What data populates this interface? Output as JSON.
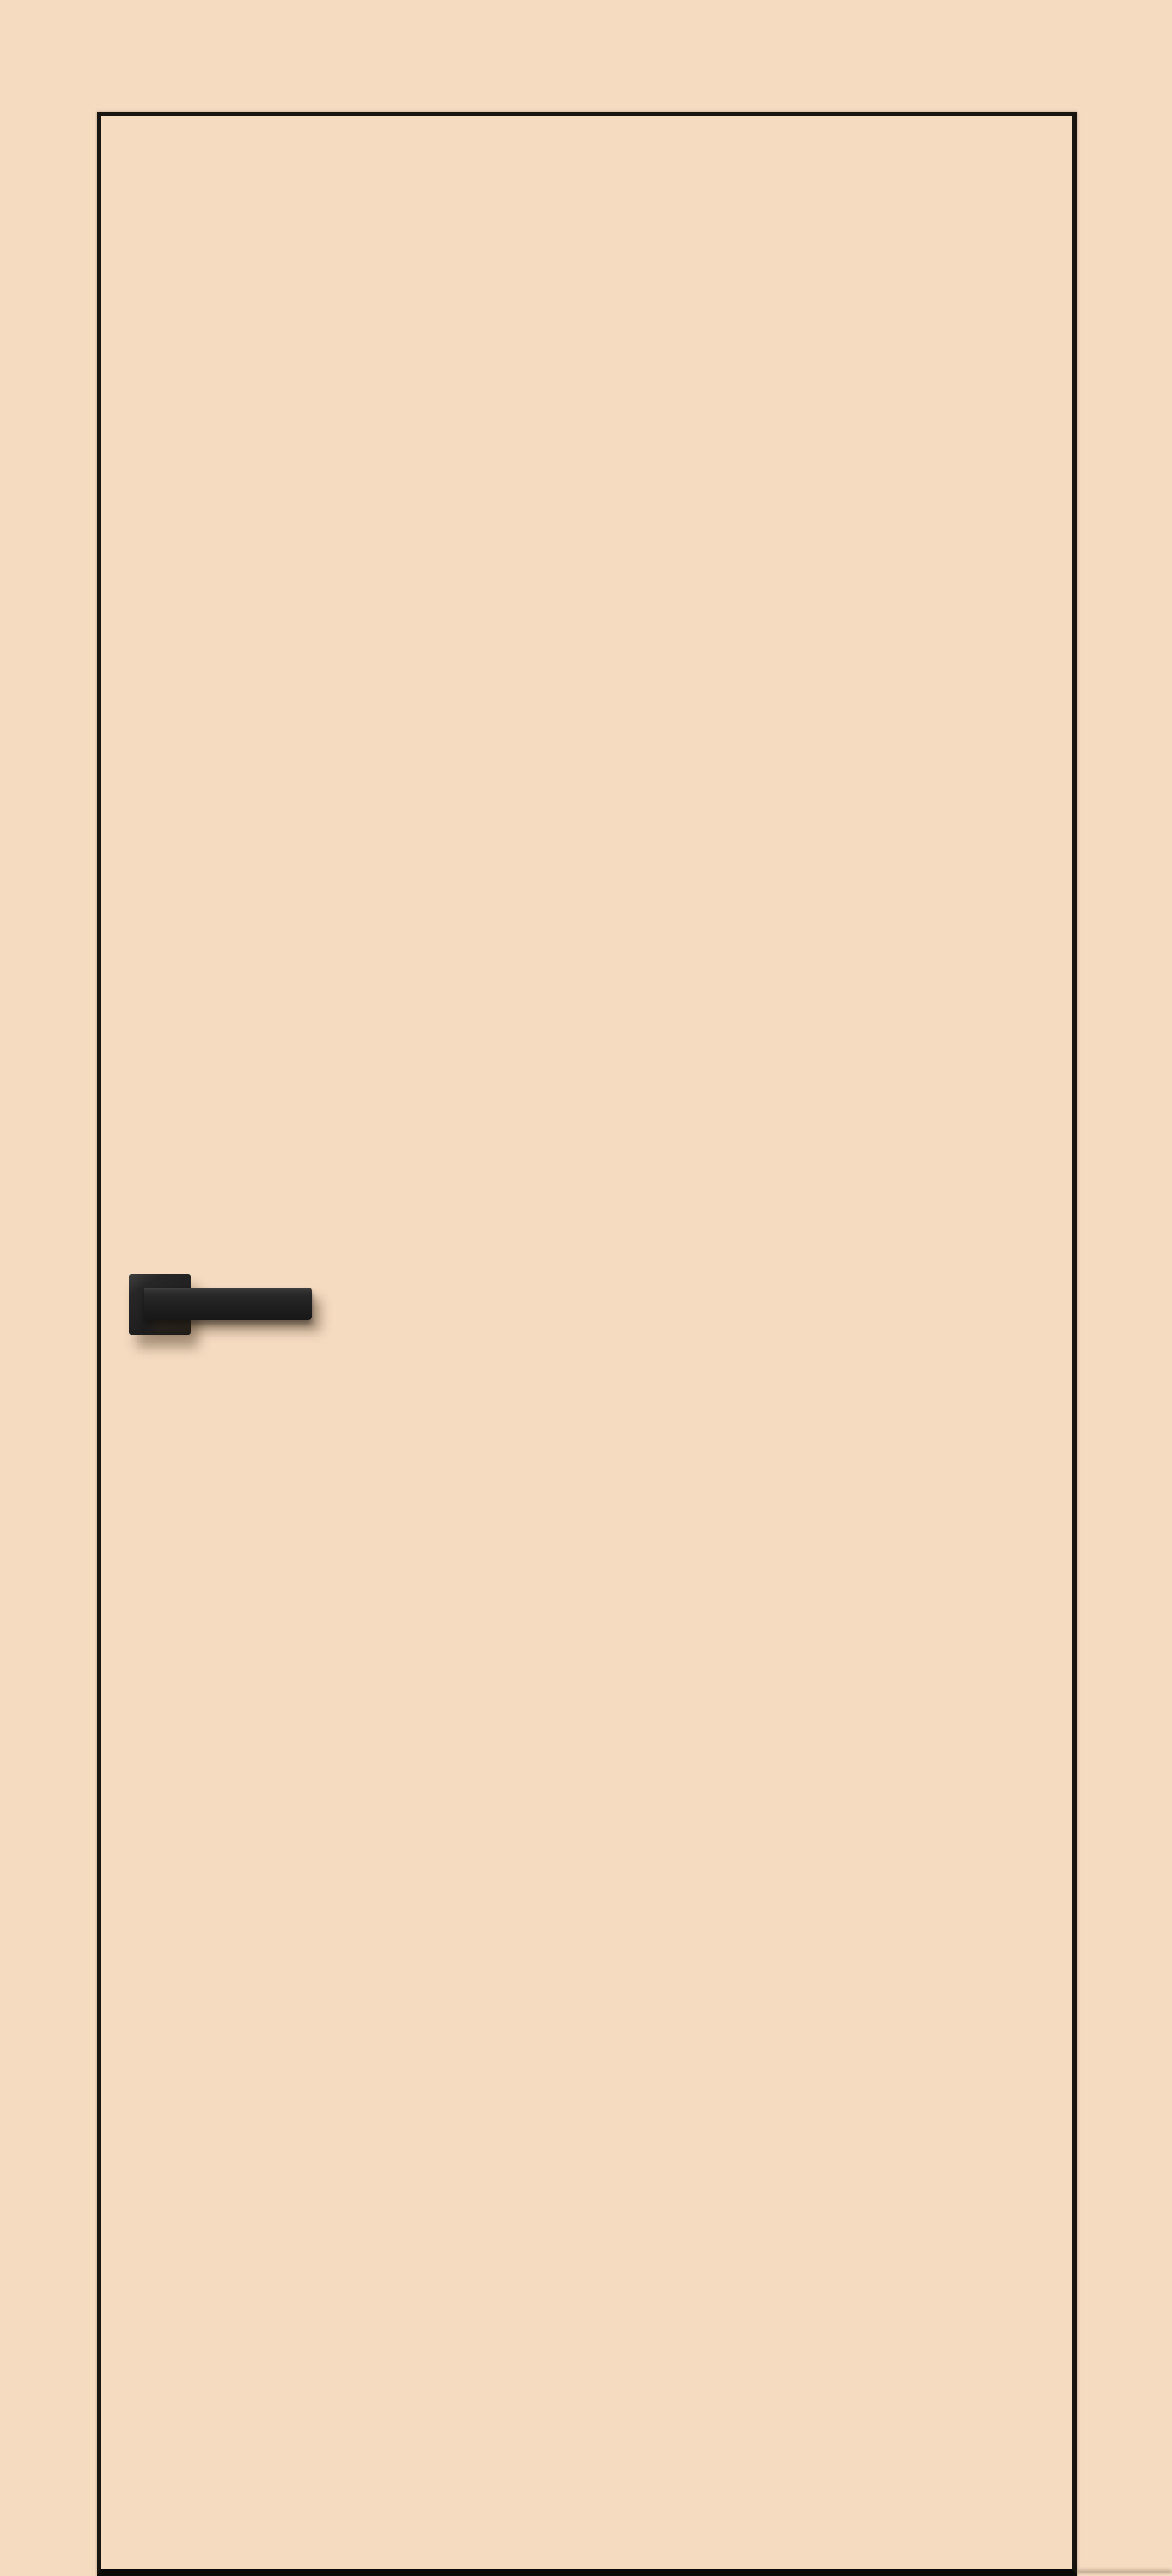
{
  "scene": {
    "description": "Product render of a closed minimalist interior door in a cream/beige finish, outlined by a thin black edge gap, with a matte black square-rosette lever handle positioned on the left side at mid height. No visible text.",
    "objects": {
      "wall": "plain beige wall, same tone as the door face",
      "door_panel": "flush beige door slab with dark edge outline, thicker dark edge at the floor",
      "door_handle": "matte black lever handle on a square rosette, pointing right, soft drop shadow on the door face"
    }
  },
  "colors": {
    "wall": "#f5dbc0",
    "door-face": "#f5dbc0",
    "outline": "#18140f",
    "bottom-edge": "#0b0a08",
    "handle-dark": "#1d1d1d",
    "handle-mid": "#272727",
    "handle-light": "#3f3f3f",
    "handle-shadow": "rgba(70,50,32,0.42)",
    "frame-shadow": "rgba(60,50,40,0.35)",
    "floor-shadow": "rgba(90,75,60,0.35)"
  }
}
